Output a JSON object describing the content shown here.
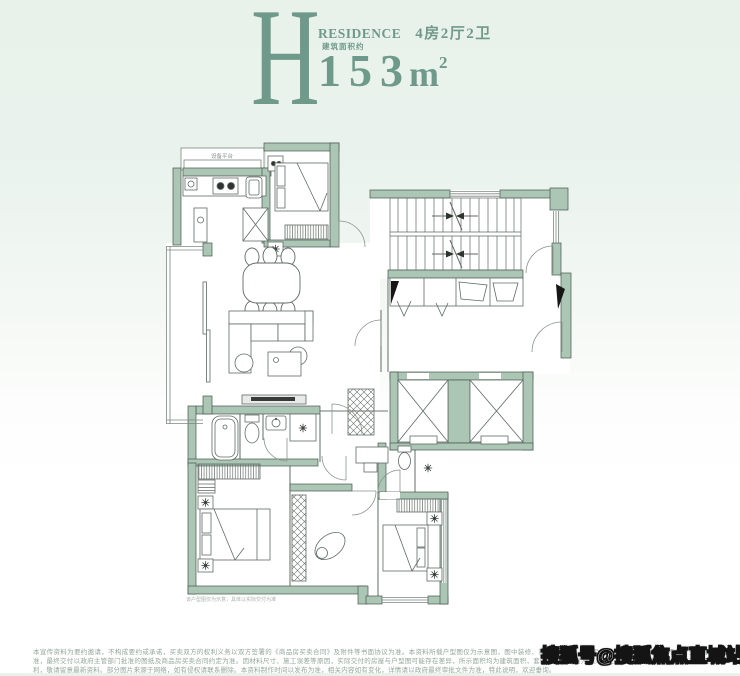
{
  "header": {
    "unit_letter": "H",
    "residence_label": "RESIDENCE",
    "layout_label": "4房2厅2卫",
    "area_prefix": "建筑面积约",
    "area_value": "153",
    "area_unit": "m",
    "area_exponent": "2",
    "accent_color": "#6f9a8b"
  },
  "floorplan": {
    "wall_color": "#abc6b4",
    "platform_label": "设备平台",
    "caption": "该户型图仅为示意，具体以实际交付为准",
    "icons": [
      "stove-icon",
      "sink-icon",
      "fridge-icon",
      "bed-icon",
      "wardrobe-icon",
      "stairs-icon",
      "elevator-icon",
      "bathtub-icon",
      "toilet-icon",
      "shower-drain-icon",
      "dining-table-icon",
      "sofa-icon",
      "tv-console-icon",
      "stool-icon",
      "entry-door-marker"
    ]
  },
  "footer": {
    "disclaimer": "本宣传资料为要约邀请，不构成要约或承诺，买卖双方的权利义务以双方签署的《商品房买卖合同》及附件等书面协议为准。本资料所载户型图仅为示意图，图中装修、家具、家电、饰品及绿植等仅为示意展示，不属于交付标准，最终交付以政府主管部门批准的图纸及商品房买卖合同约定为准。因材料尺寸、施工误差等原因，实际交付的房屋与户型图可能存在差异，所示面积均为建筑面积，套内面积以实测为准。开发商保留对宣传资料进行修改的权利，敬请留意最新资料。部分图片来源于网络，如有侵权请联系删除。本资料制作时间以发布为准，相关内容如有变化，详情请以政府最终审批文件为准，特此说明，欢迎垂询。",
    "watermark": "搜狐号@搜狐焦点直城站"
  }
}
